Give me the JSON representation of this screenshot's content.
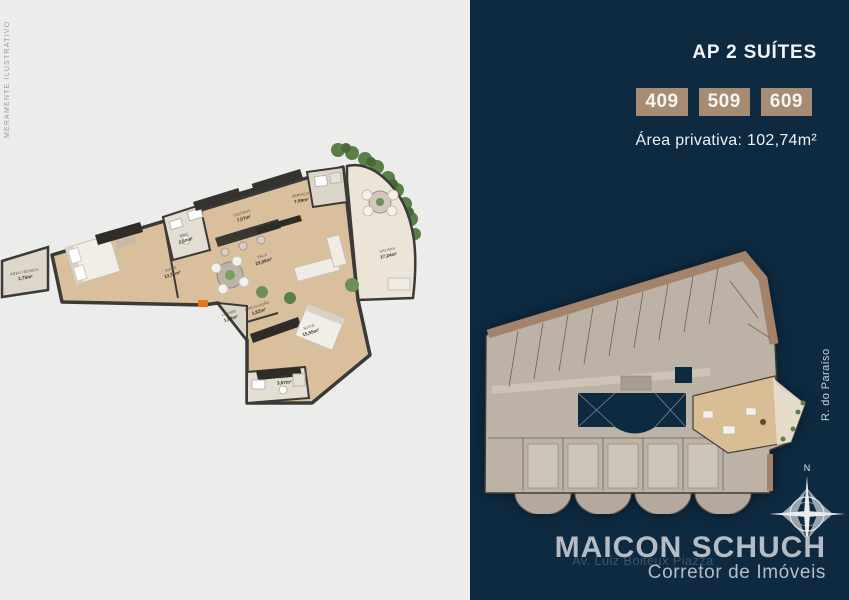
{
  "colors": {
    "panel_navy": "#0e2a41",
    "panel_light": "#ececeb",
    "badge_tan": "#a68c72",
    "brand_gray": "#b6bcc4",
    "plan_wall": "#3a3a38",
    "plan_floor": "#d9bf9c",
    "footprint_fill": "#bdb2a6",
    "footprint_band": "#a3846a",
    "greenery": "#5c7f49",
    "entrance_orange": "#e0761e"
  },
  "left_panel": {
    "watermark": "MERAMENTE ILUSTRATIVO",
    "floorplan": {
      "rooms": [
        {
          "name": "ÁREA TÉCNICA",
          "area": "2,75m²"
        },
        {
          "name": "SUÍTE",
          "area": "13,71m²"
        },
        {
          "name": "BWC",
          "area": "2,60m²"
        },
        {
          "name": "COZINHA",
          "area": "7,07m²"
        },
        {
          "name": "SERVIÇO",
          "area": "7,69m²"
        },
        {
          "name": "SALA",
          "area": "23,06m²"
        },
        {
          "name": "SACADA",
          "area": "17,24m²"
        },
        {
          "name": "LAVABO",
          "area": "1,84m²"
        },
        {
          "name": "CIRCULAÇÃO",
          "area": "1,82m²"
        },
        {
          "name": "SUÍTE",
          "area": "15,55m²"
        },
        {
          "name": "BWC",
          "area": "3,57m²"
        }
      ]
    }
  },
  "right_panel": {
    "title": "AP 2 SUÍTES",
    "units": [
      "409",
      "509",
      "609"
    ],
    "private_area_label": "Área privativa: 102,74m²",
    "street_label": "R. do Paraíso",
    "compass_north_label": "N",
    "brand": {
      "address": "Av. Luiz Boiteux Piazza",
      "name": "MAICON SCHUCH",
      "tagline": "Corretor de Imóveis"
    }
  }
}
